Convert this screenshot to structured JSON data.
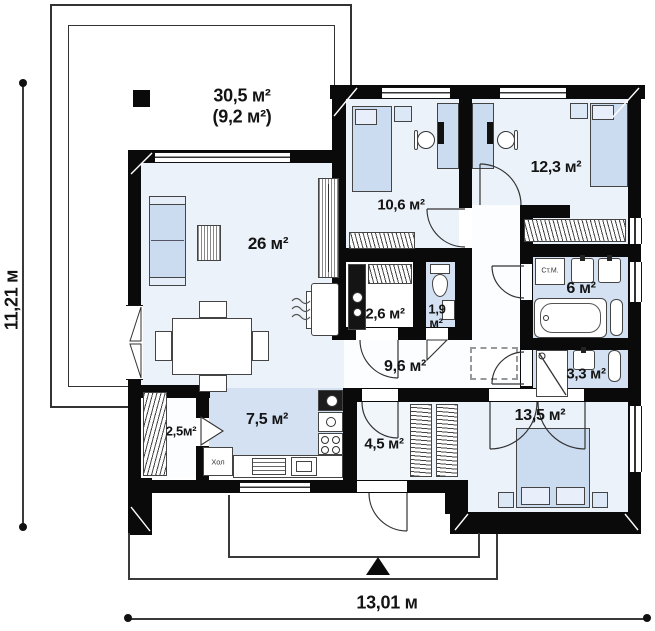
{
  "title": "single-storey house floor plan",
  "terrace": {
    "area_main": "30,5 м²",
    "area_alt": "(9,2 м²)"
  },
  "rooms": [
    {
      "name": "living-room",
      "area": "26 м²"
    },
    {
      "name": "bedroom-1",
      "area": "10,6 м²"
    },
    {
      "name": "bedroom-2",
      "area": "12,3 м²"
    },
    {
      "name": "boiler-room",
      "area": "2,6 м²"
    },
    {
      "name": "wc",
      "line1": "1,9",
      "line2": "м²"
    },
    {
      "name": "hallway",
      "area": "9,6 м²"
    },
    {
      "name": "bathroom",
      "area": "6 м²"
    },
    {
      "name": "shower-room",
      "area": "3,3 м²"
    },
    {
      "name": "bedroom-3",
      "area": "13,5 м²"
    },
    {
      "name": "entry-hall",
      "area": "4,5 м²"
    },
    {
      "name": "kitchen",
      "area": "7,5 м²"
    },
    {
      "name": "pantry",
      "area": "2,5м²"
    }
  ],
  "appliances": {
    "fridge": "Хол",
    "washer": "Ст.М."
  },
  "dimensions": {
    "height": "11,21 м",
    "width": "13,01 м"
  },
  "colors": {
    "wall": "#0a0a0a",
    "floor_light": "#ecf2fa",
    "floor_blue": "#d3e1f2",
    "furniture_blue": "#ccdcf0"
  }
}
